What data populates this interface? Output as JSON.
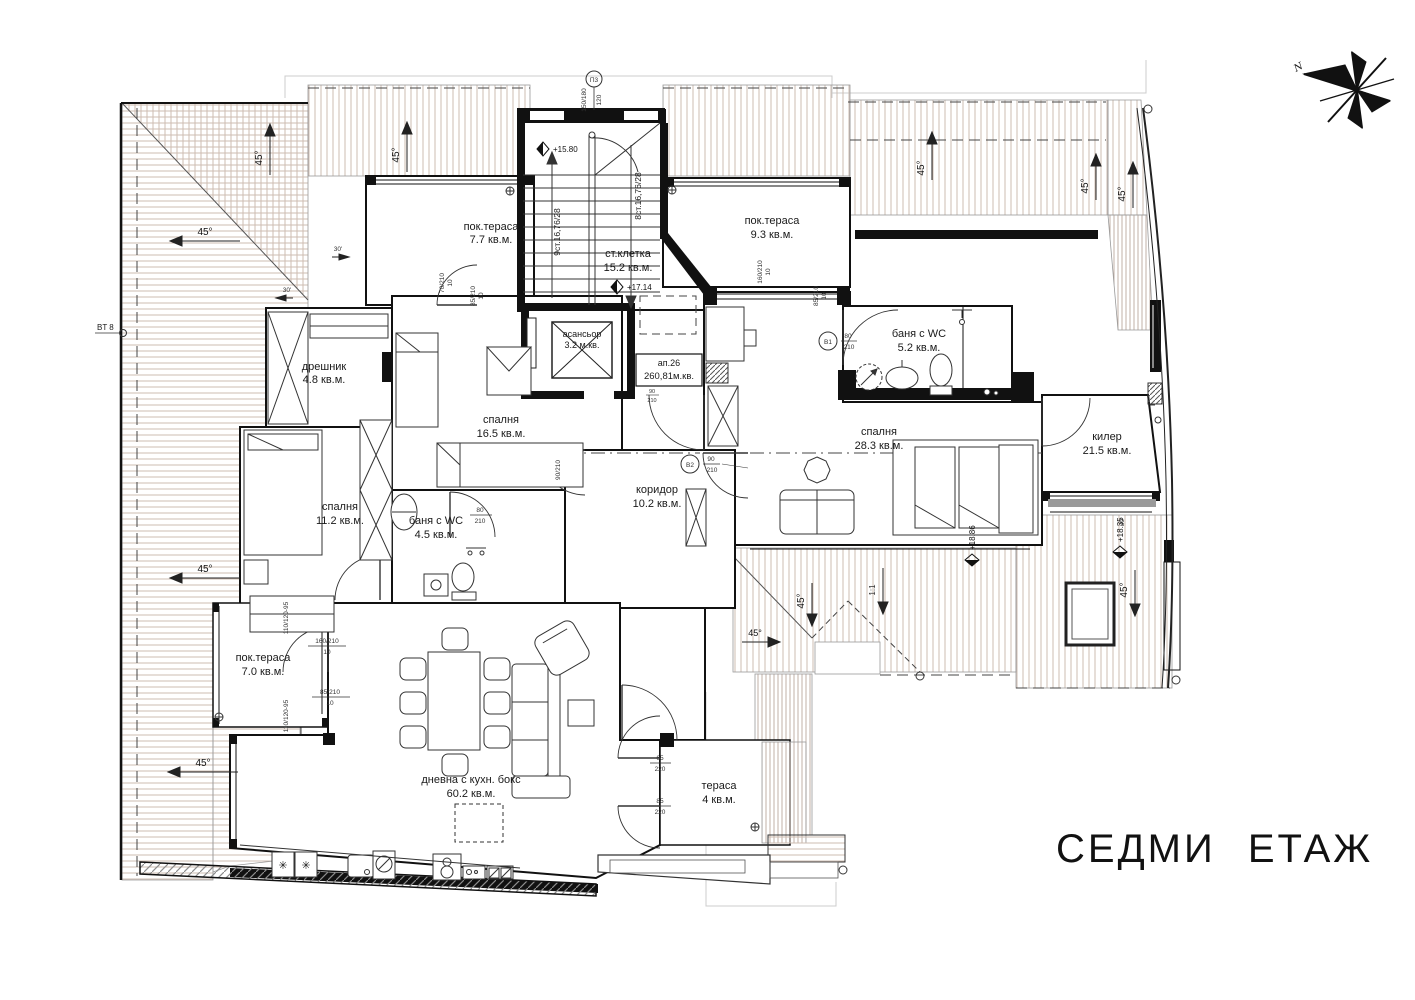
{
  "title": "СЕДМИ ЕТАЖ",
  "compass": {
    "north": "N"
  },
  "apartment": {
    "label": "ап.26",
    "area": "260,81м.кв.",
    "door_w": "90",
    "door_h": "210"
  },
  "rooms": [
    {
      "name": "пок.тераса",
      "area": "7.7 кв.м."
    },
    {
      "name": "ст.клетка",
      "area": "15.2 кв.м."
    },
    {
      "name": "пок.тераса",
      "area": "9.3 кв.м."
    },
    {
      "name": "дрешник",
      "area": "4.8 кв.м."
    },
    {
      "name": "асансьор",
      "area": "3.2 м.кв."
    },
    {
      "name": "баня с WC",
      "area": "5.2 кв.м."
    },
    {
      "name": "спалня",
      "area": "16.5 кв.м."
    },
    {
      "name": "спалня",
      "area": "28.3 кв.м."
    },
    {
      "name": "килер",
      "area": "21.5 кв.м."
    },
    {
      "name": "спалня",
      "area": "11.2 кв.м."
    },
    {
      "name": "коридор",
      "area": "10.2 кв.м."
    },
    {
      "name": "баня с WC",
      "area": "4.5 кв.м."
    },
    {
      "name": "пок.тераса",
      "area": "7.0 кв.м."
    },
    {
      "name": "дневна с кухн. бокс",
      "area": "60.2 кв.м."
    },
    {
      "name": "тераса",
      "area": "4 кв.м."
    }
  ],
  "stairs": {
    "flight_left": "9ст.16,76/28",
    "flight_right": "8ст.16,76/28",
    "grid_mark": "П3"
  },
  "levels": {
    "stair_landing": "+15.80",
    "floor": "+17.14",
    "roof_left": "+18.86",
    "roof_right": "+18.35"
  },
  "slopes": {
    "deg45": "45°",
    "deg30": "30'",
    "ratio": "1:1"
  },
  "doors": {
    "b1": "B1",
    "b1_w": "80",
    "b1_h": "210",
    "b2": "B2",
    "b2_w": "90",
    "b2_h": "210"
  },
  "dims": {
    "d70": "70/210",
    "d85": "85/210",
    "d160": "160/210",
    "d110": "110/120-95",
    "d65_w": "65",
    "d65_h": "220",
    "d85_w": "85",
    "d85_h": "220",
    "d80_w": "80",
    "d80_h": "210",
    "d150": "150/180",
    "d120": "120",
    "d90": "90/210",
    "sub": "10"
  },
  "misc": {
    "bt8": "BT 8",
    "star": "✳"
  },
  "colors": {
    "hatch": "#c9b8ae",
    "wall": "#111111",
    "dash": "#444444"
  }
}
